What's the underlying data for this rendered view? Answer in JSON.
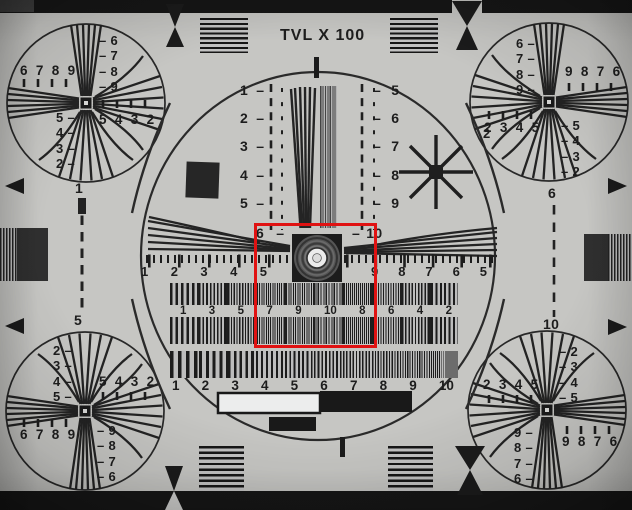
{
  "title": "TVL X 100",
  "colors": {
    "paper": "#c6c6c3",
    "ink": "#1d1d1d",
    "roi_red": "#e01212"
  },
  "roi": {
    "x": 254,
    "y": 223,
    "width": 123,
    "height": 125
  },
  "corners": {
    "top_left": {
      "upper_h": "6 7 8 9",
      "upper_v": "– 6\n– 7\n– 8\n– 9",
      "lower_v": "5 –\n4 –\n3 –\n2 –",
      "lower_h": "5 4 3 2"
    },
    "top_right": {
      "upper_v": "6 –\n7 –\n8 –\n9 –",
      "upper_h": "9 8 7 6",
      "lower_h": "2 3 4 5",
      "lower_v": "– 5\n– 4\n– 3\n– 2"
    },
    "bottom_left": {
      "upper_v": "2 –\n3 –\n4 –\n5 –",
      "upper_h": "5 4 3 2",
      "lower_h": "6 7 8 9",
      "lower_v": "– 9\n– 8\n– 7\n– 6"
    },
    "bottom_right": {
      "upper_h": "2 3 4 5",
      "upper_v": "– 2\n– 3\n– 4\n– 5",
      "lower_v": "9 –\n8 –\n7 –\n6 –",
      "lower_h": "9 8 7 6"
    }
  },
  "center": {
    "left_scale": "1 –\n2 –\n3 –\n4 –\n5 –",
    "left_scale_end": "6 –",
    "right_scale": "– 5\n– 6\n– 7\n– 8\n– 9",
    "right_scale_end": "– 10",
    "ruler_left": [
      "1",
      "2",
      "3",
      "4",
      "5"
    ],
    "ruler_right": [
      "9",
      "8",
      "7",
      "6",
      "5"
    ],
    "curve_label": "2"
  },
  "bars": {
    "row_labels": [
      "1",
      "3",
      "5",
      "7",
      "9",
      "10",
      "8",
      "6",
      "4",
      "2"
    ],
    "sweep_labels": [
      "1",
      "2",
      "3",
      "4",
      "5",
      "6",
      "7",
      "8",
      "9",
      "10"
    ]
  },
  "edges": {
    "left_top": "1",
    "left_bottom": "5",
    "right_top": "6",
    "right_bottom": "10"
  }
}
